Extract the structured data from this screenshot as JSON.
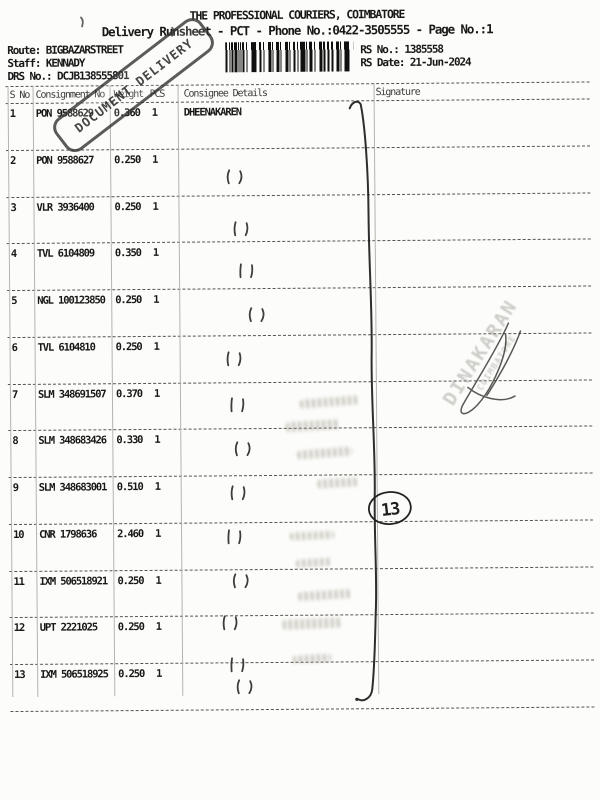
{
  "header": {
    "title": "THE PROFESSIONAL COURIERS, COIMBATORE",
    "subtitle": "Delivery Runsheet - PCT - Phone No.:0422-3505555 - Page No.:1",
    "route_label": "Route:",
    "route_value": "BIGBAZARSTREET",
    "staff_label": "Staff:",
    "staff_value": "KENNADY",
    "drs_label": "DRS No.:",
    "drs_value": "DCJB138555801",
    "rs_no_label": "RS No.:",
    "rs_no_value": "1385558",
    "rs_date_label": "RS Date:",
    "rs_date_value": "21-Jun-2024"
  },
  "stamps": {
    "out_stamp_text": "DOCUMENT DELIVERY",
    "receiver_stamp_line1": "DINAKARAN",
    "receiver_stamp_line2": "COIMBATORE",
    "handwritten_count": "13"
  },
  "table": {
    "columns": [
      "S No",
      "Consignment No",
      "Weight",
      "PCS",
      "Consignee Details",
      "Signature"
    ],
    "rows": [
      {
        "s_no": "1",
        "consignment_no": "PON 9588629",
        "weight": "0.360",
        "pcs": "1",
        "consignee": "DHEENAKAREN"
      },
      {
        "s_no": "2",
        "consignment_no": "PON 9588627",
        "weight": "0.250",
        "pcs": "1",
        "consignee": ""
      },
      {
        "s_no": "3",
        "consignment_no": "VLR 3936400",
        "weight": "0.250",
        "pcs": "1",
        "consignee": ""
      },
      {
        "s_no": "4",
        "consignment_no": "TVL 6104809",
        "weight": "0.350",
        "pcs": "1",
        "consignee": ""
      },
      {
        "s_no": "5",
        "consignment_no": "NGL 100123850",
        "weight": "0.250",
        "pcs": "1",
        "consignee": ""
      },
      {
        "s_no": "6",
        "consignment_no": "TVL 6104810",
        "weight": "0.250",
        "pcs": "1",
        "consignee": ""
      },
      {
        "s_no": "7",
        "consignment_no": "SLM 348691507",
        "weight": "0.370",
        "pcs": "1",
        "consignee": ""
      },
      {
        "s_no": "8",
        "consignment_no": "SLM 348683426",
        "weight": "0.330",
        "pcs": "1",
        "consignee": ""
      },
      {
        "s_no": "9",
        "consignment_no": "SLM 348683001",
        "weight": "0.510",
        "pcs": "1",
        "consignee": ""
      },
      {
        "s_no": "10",
        "consignment_no": "CNR 1798636",
        "weight": "2.460",
        "pcs": "1",
        "consignee": ""
      },
      {
        "s_no": "11",
        "consignment_no": "IXM 506518921",
        "weight": "0.250",
        "pcs": "1",
        "consignee": ""
      },
      {
        "s_no": "12",
        "consignment_no": "UPT 2221025",
        "weight": "0.250",
        "pcs": "1",
        "consignee": ""
      },
      {
        "s_no": "13",
        "consignment_no": "IXM 506518925",
        "weight": "0.250",
        "pcs": "1",
        "consignee": ""
      }
    ]
  }
}
